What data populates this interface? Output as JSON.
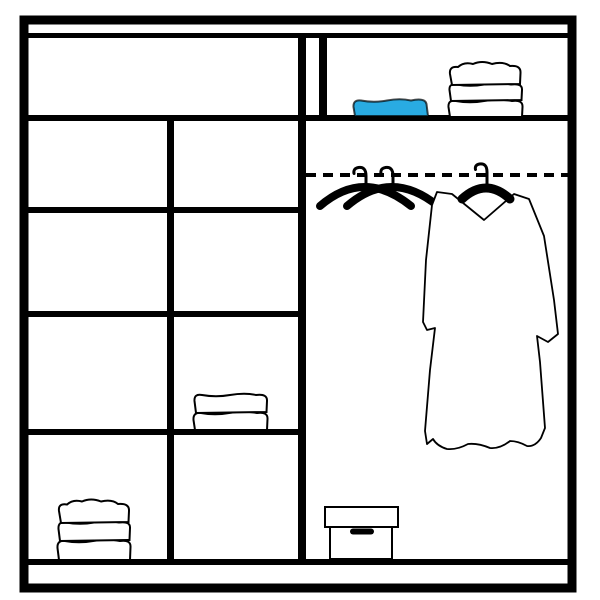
{
  "title": "Wardrobe interior organization diagram",
  "colors": {
    "background": "#ffffff",
    "line": "#000000",
    "accent": "#29abe2",
    "item_fill": "#ffffff"
  },
  "wardrobe": {
    "frame": "double-line outer cabinet frame",
    "sections": {
      "top_shelf_left": {
        "contents": []
      },
      "top_shelf_right": {
        "contents": [
          {
            "item": "blue-folded-towel",
            "color": "#29abe2"
          },
          {
            "item": "white-towel-stack",
            "layers": 3
          }
        ]
      },
      "left_shelving_grid": {
        "columns": 2,
        "rows": 4,
        "contents": [
          {
            "item": "white-towel-stack",
            "layers": 2,
            "row": 3,
            "column": 2
          },
          {
            "item": "white-towel-stack",
            "layers": 3,
            "row": 4,
            "column": 1
          }
        ]
      },
      "hanging_area": {
        "rail_style": "dashed",
        "contents": [
          {
            "item": "empty-hanger",
            "count": 2
          },
          {
            "item": "hanging-robe",
            "on": "black-hanger"
          },
          {
            "item": "storage-box",
            "position": "floor"
          }
        ]
      }
    }
  }
}
